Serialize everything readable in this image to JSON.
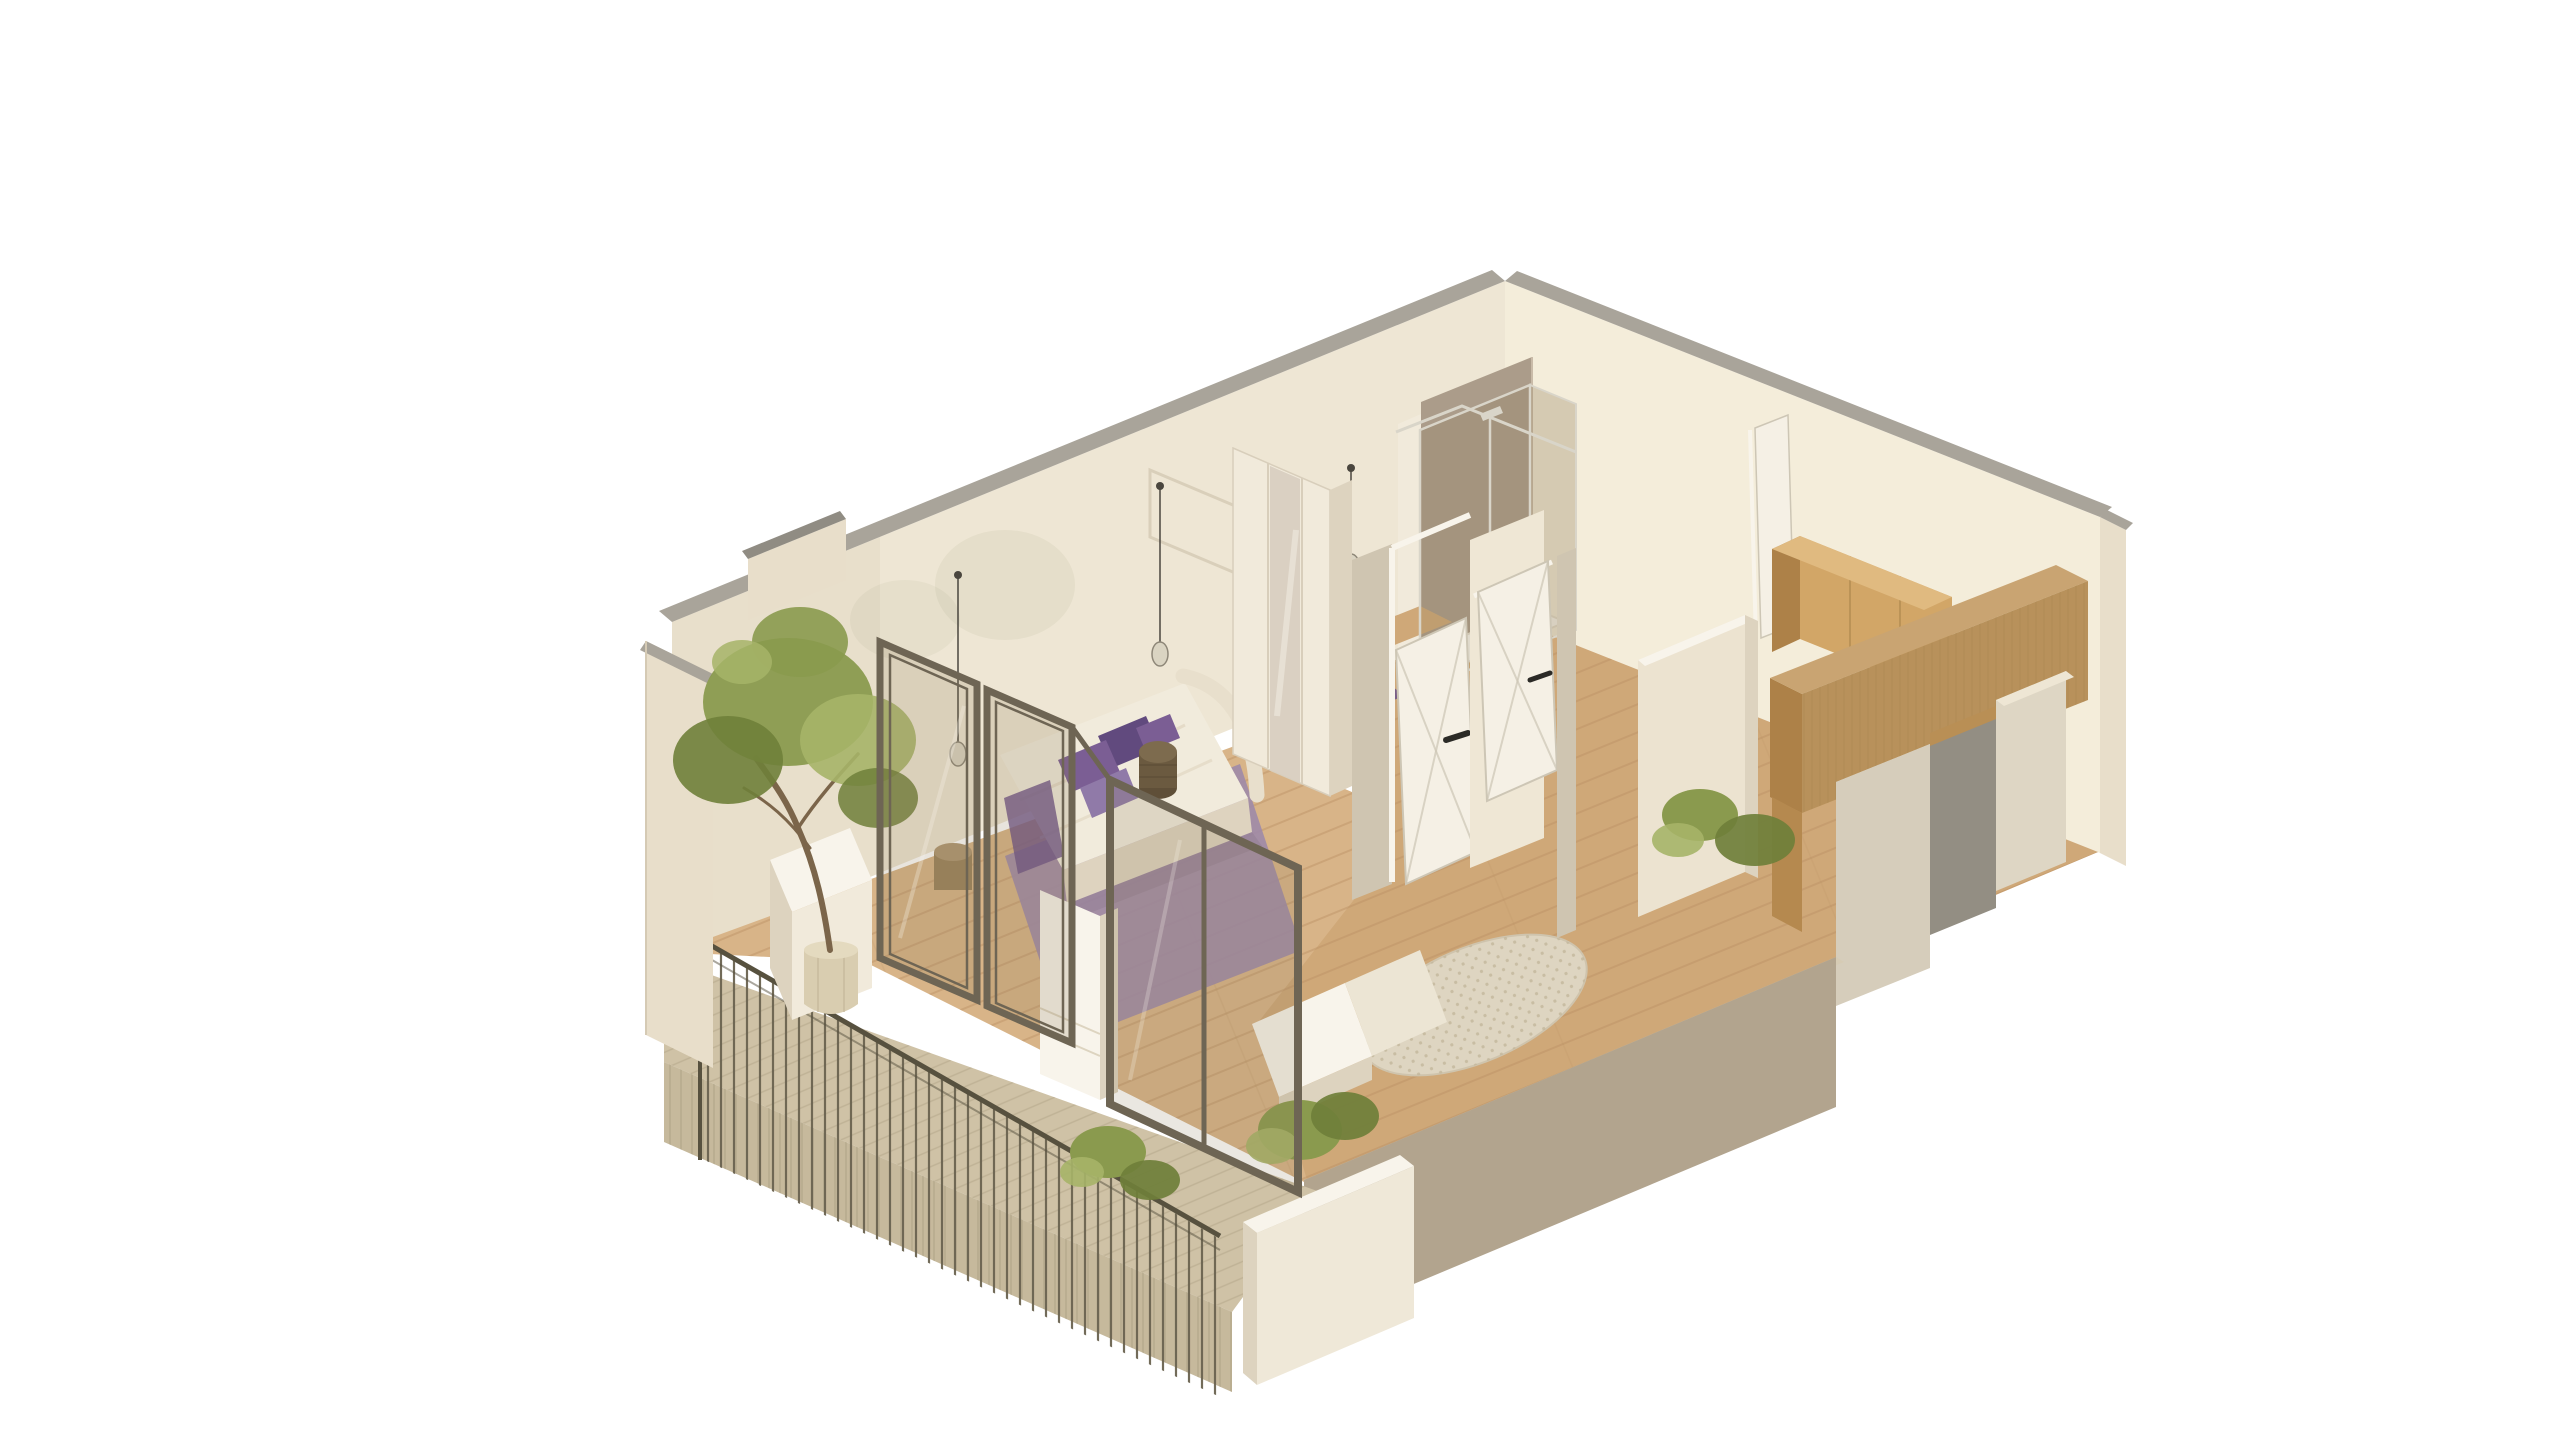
{
  "meta": {
    "description": "Isometric 3D cutaway render of a one-bedroom apartment with terrace, shown on a plain white background. No text or UI controls are visible.",
    "view": "axonometric cutaway from above",
    "background": "#ffffff"
  },
  "scene": {
    "rooms": [
      "bedroom",
      "bathroom-shower",
      "wc",
      "hallway",
      "living-area",
      "kitchen",
      "terrace"
    ],
    "objects": [
      "bedroom-back-wall",
      "kitchen-back-wall",
      "gray-wall-caps",
      "west-end-wall",
      "bed-with-purple-pillows",
      "purple-bedroom-rug",
      "woven-side-table",
      "wicker-basket",
      "wardrobe-with-mirror-door",
      "pendant-lights",
      "framed-wall-art-shadow",
      "shower-tile-wall",
      "shower-glass-enclosure",
      "shower-tray",
      "toilet",
      "gray-pouf",
      "purple-bath-mat",
      "white-interior-doors-with-cross-bracing",
      "entry-door-white",
      "oak-upper-cabinets",
      "oak-counter-run",
      "oak-floor-column",
      "hall-half-wall",
      "indoor-shrub",
      "gray-exterior-door",
      "exterior-cream-volumes",
      "wood-plank-flooring",
      "round-pebble-rug",
      "white-sill-steps",
      "taupe-front-cut-wall",
      "white-planter-wall-with-shrub",
      "bronze-framed-glass-terrace-doors",
      "white-pillar",
      "terrace-deck",
      "deck-fascia",
      "metal-baluster-railing",
      "potted-tree",
      "terrace-shrub"
    ]
  },
  "palette": {
    "bg": "#ffffff",
    "wallA": "#eee6d4",
    "wallAshade": "#e3d8c3",
    "wallB": "#f4edda",
    "wallC": "#e8deca",
    "cap": "#a9a49a",
    "capDark": "#908c83",
    "tile": "#ab9c8a",
    "tileEdge": "#c9bba8",
    "cream": "#f1eadb",
    "creamBright": "#efe7d5",
    "creamShade": "#ddd3bf",
    "white": "#f8f4eb",
    "woodFloor": "#cfa878",
    "woodFloorLight": "#d8b488",
    "plankLine": "#b98f62",
    "deck": "#cfc2a6",
    "deckLine": "#b3a688",
    "fascia": "#c6b99c",
    "fasciaLine": "#a89b7e",
    "taupe": "#b2a48e",
    "taupeTop": "#d6cbb4",
    "taupeFace": "#cfc5b1",
    "oakFront": "#d2a667",
    "oakSide": "#ad8148",
    "oakTop": "#e0ba80",
    "counterTop": "#c9a472",
    "counterFront": "#b8915b",
    "columnOak": "#b5894f",
    "grainLine": "#a07c45",
    "grayDoor": "#938e83",
    "oakLintel": "#b98f55",
    "glassTint": "#8d7a57",
    "frame": "#6e6554",
    "chrome": "#d9d5c9",
    "railing": "#6a6350",
    "rail": "#57513f",
    "green": "#8a9a4e",
    "greenDark": "#6f7f3a",
    "greenLight": "#a6b468",
    "trunk": "#7b654a",
    "pot": "#d9cdb0",
    "potTop": "#e4dabf",
    "potShade": "#c4b79a",
    "purple": "#7b5e94",
    "purpleDark": "#614a7e",
    "purpleLight": "#907aa8",
    "rugPurple": "#9e8aa9",
    "rugStroke": "#cfc4ad",
    "matPurple": "#6b5188",
    "bedCream": "#f1ebdc",
    "bedShade": "#ded3bf",
    "duvetLine": "#e3d9c5",
    "headboard": "#e8dfcc",
    "tableTop": "#7d6b4e",
    "tableDark": "#6b5a40",
    "tableBase": "#5f4f38",
    "weave": "#5a4b36",
    "basket": "#ae9672",
    "basketDark": "#9a835c",
    "pebble": "#ded5c1",
    "pebbleDot": "#c3b69b",
    "cord": "#4a463e",
    "bulb": "#dad4c2",
    "bulbStroke": "#8e8778",
    "doorWhite": "#f5f0e5",
    "doorLine": "#cdc6b5",
    "handle": "#2b2a26",
    "toilet": "#f8f5ee",
    "bowlStroke": "#ddd6c6",
    "trayStroke": "#e4ddcd",
    "pouf": "#9b948a",
    "poufTop": "#a8a296",
    "mirror": "#d8cfc1",
    "seam": "#d8cebb",
    "wallArt": "#d9cfba",
    "shadowTint": "#6b7a4a",
    "extCreamL": "#d6cdbb",
    "extCreamLTop": "#e9e1cf",
    "extCreamR": "#ded6c4",
    "planterFront": "#efe8d8",
    "halfWall": "#ece3d0",
    "sillStep": "#ece5d4",
    "grooves": "#ddd4c0",
    "slabEdge": "#d5cab4",
    "black": "#000000"
  }
}
